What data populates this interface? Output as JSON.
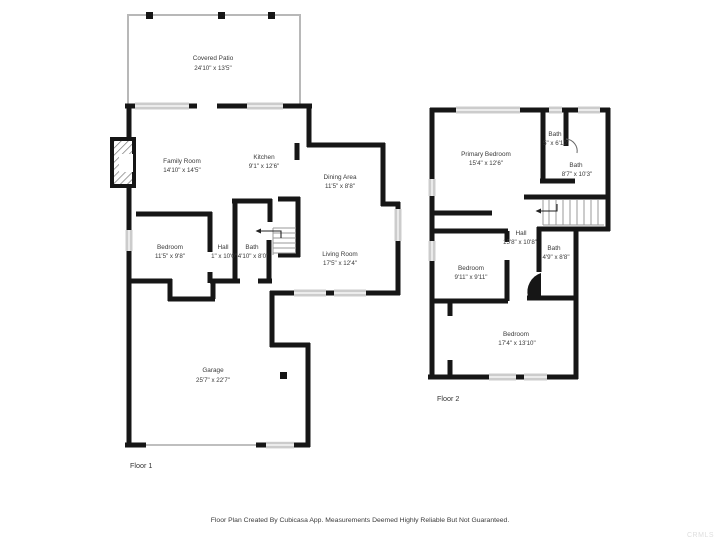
{
  "floor1": {
    "label": "Floor 1",
    "rooms": {
      "covered_patio": {
        "name": "Covered Patio",
        "dims": "24'10\" x 13'5\""
      },
      "family_room": {
        "name": "Family Room",
        "dims": "14'10\" x 14'5\""
      },
      "kitchen": {
        "name": "Kitchen",
        "dims": "9'1\" x 12'6\""
      },
      "dining_area": {
        "name": "Dining Area",
        "dims": "11'5\" x 8'8\""
      },
      "living_room": {
        "name": "Living Room",
        "dims": "17'5\" x 12'4\""
      },
      "bedroom": {
        "name": "Bedroom",
        "dims": "11'5\" x 9'8\""
      },
      "hall": {
        "name": "Hall",
        "dims": "1\" x 10'0\""
      },
      "bath": {
        "name": "Bath",
        "dims": "4'10\" x 8'0\""
      },
      "garage": {
        "name": "Garage",
        "dims": "25'7\" x 22'7\""
      }
    }
  },
  "floor2": {
    "label": "Floor 2",
    "rooms": {
      "primary_bedroom": {
        "name": "Primary Bedroom",
        "dims": "15'4\" x 12'6\""
      },
      "bath_small": {
        "name": "Bath",
        "dims": "5\" x 6'10\""
      },
      "bath_upper": {
        "name": "Bath",
        "dims": "8'7\" x 10'3\""
      },
      "hall": {
        "name": "Hall",
        "dims": "15'8\" x 10'8\""
      },
      "bath_lower": {
        "name": "Bath",
        "dims": "4'9\" x 8'8\""
      },
      "bedroom_mid": {
        "name": "Bedroom",
        "dims": "9'11\" x 9'11\""
      },
      "bedroom_large": {
        "name": "Bedroom",
        "dims": "17'4\" x 13'10\""
      }
    }
  },
  "footer": {
    "disclaimer": "Floor Plan Created By Cubicasa App. Measurements Deemed Highly Reliable But Not Guaranteed.",
    "watermark": "CRMLS"
  }
}
